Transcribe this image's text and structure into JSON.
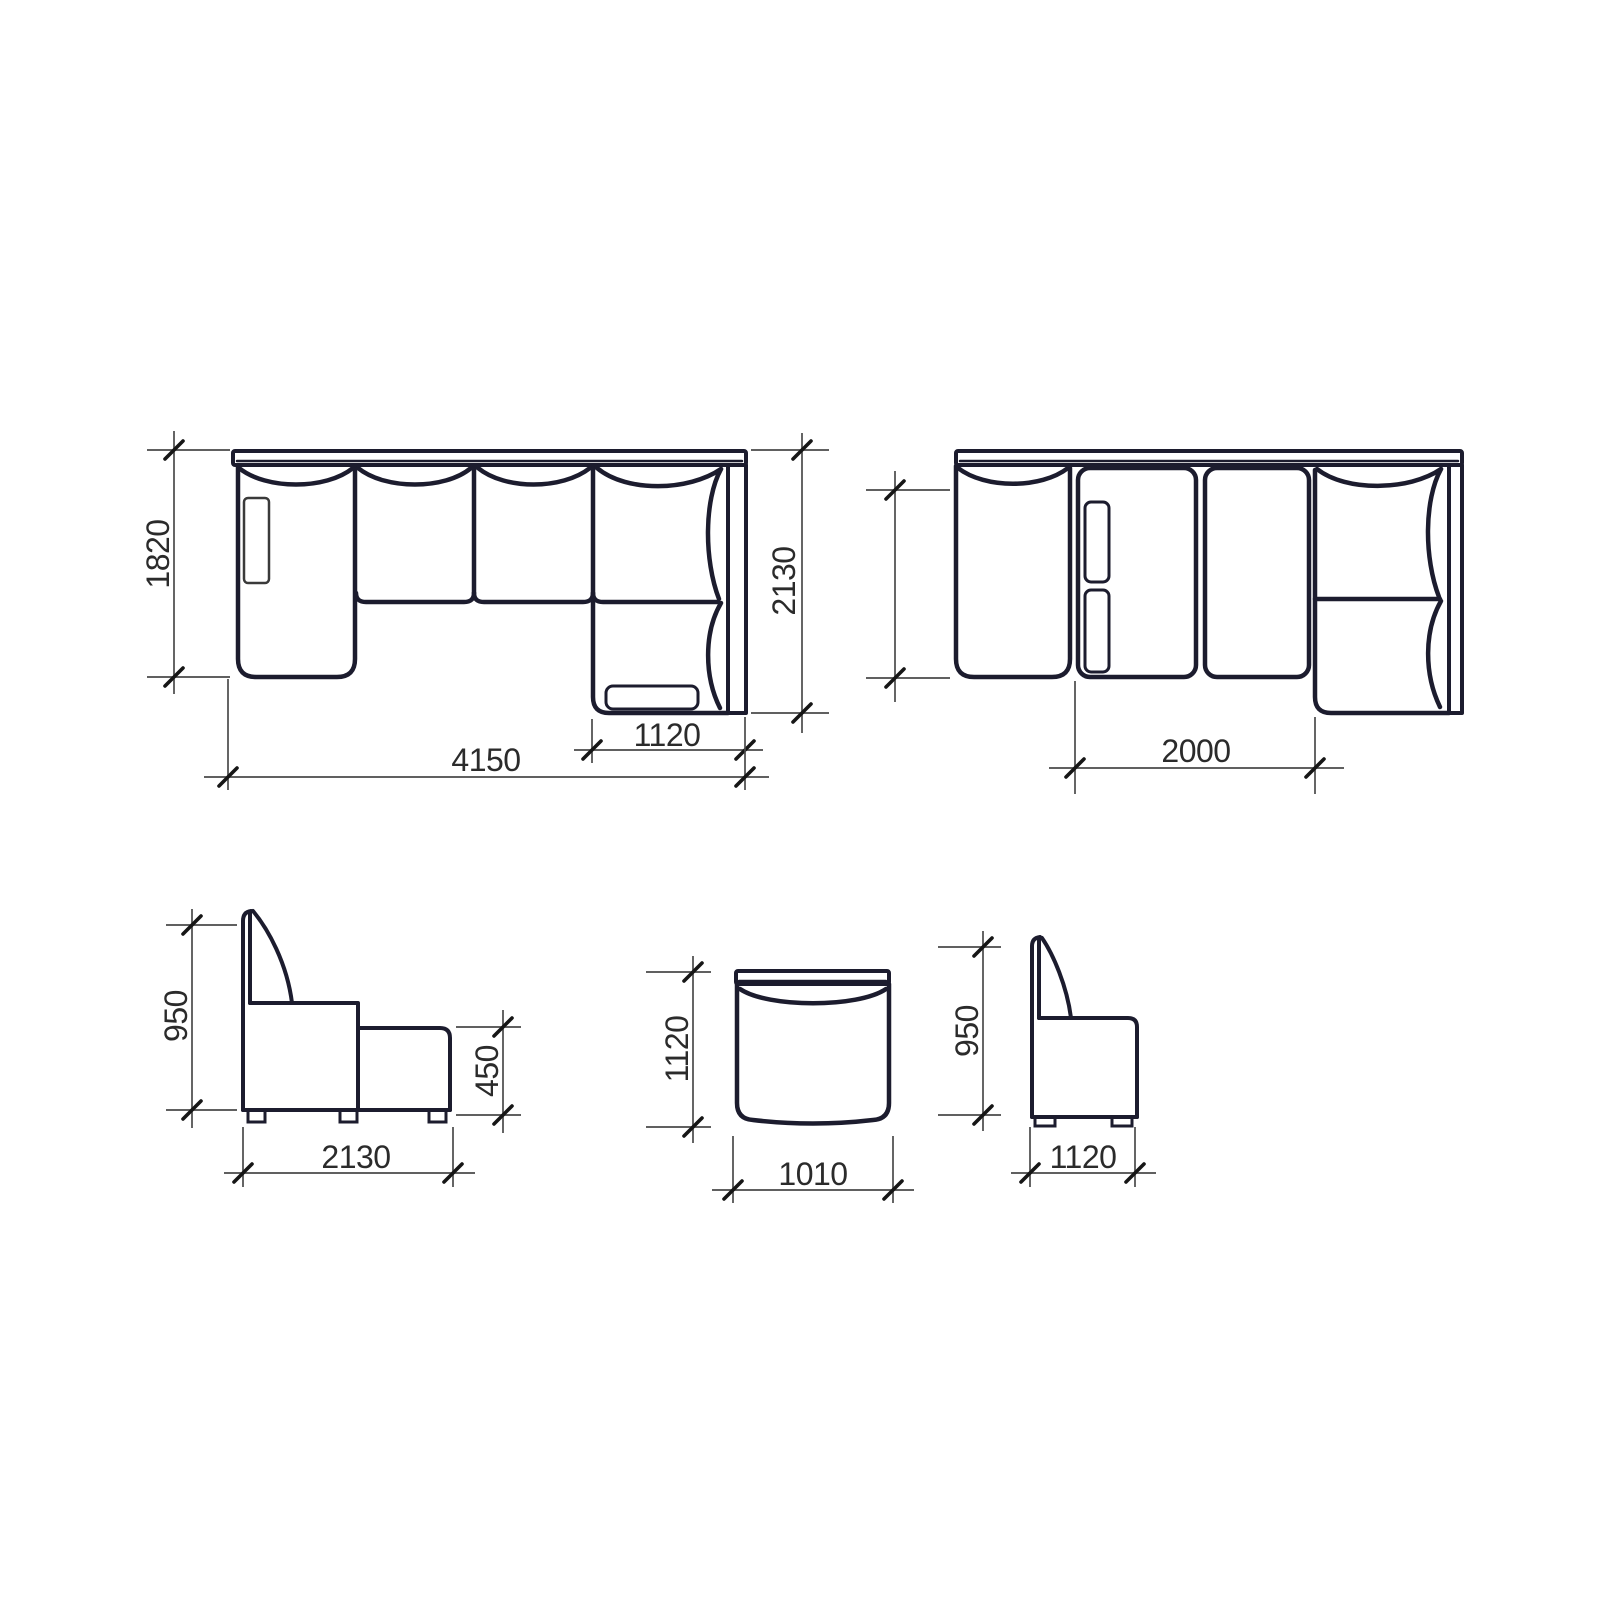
{
  "drawing": {
    "title": "Corner sofa technical dimension drawing",
    "views": {
      "plan_lshape": {
        "name": "corner-sofa-plan-view",
        "dim_left_depth": "1820",
        "dim_right_depth": "2130",
        "dim_corner_width": "1120",
        "dim_total_width": "4150"
      },
      "plan_bed": {
        "name": "sofa-bed-plan-view",
        "dim_left_depth": "",
        "dim_bed_span": "2000"
      },
      "side_chaise": {
        "name": "sofa-side-view",
        "dim_height": "950",
        "dim_ottoman_height": "450",
        "dim_total_depth": "2130"
      },
      "plan_module": {
        "name": "module-plan-view",
        "dim_depth": "1120",
        "dim_width": "1010"
      },
      "side_module": {
        "name": "module-side-view",
        "dim_height": "950",
        "dim_depth": "1120"
      }
    }
  },
  "colors": {
    "outline": "#1c1c2e",
    "dim": "#4a4a4a",
    "tick": "#161616",
    "text": "#2b2b2b",
    "detail": "#3a3a3a",
    "background": "#ffffff"
  }
}
